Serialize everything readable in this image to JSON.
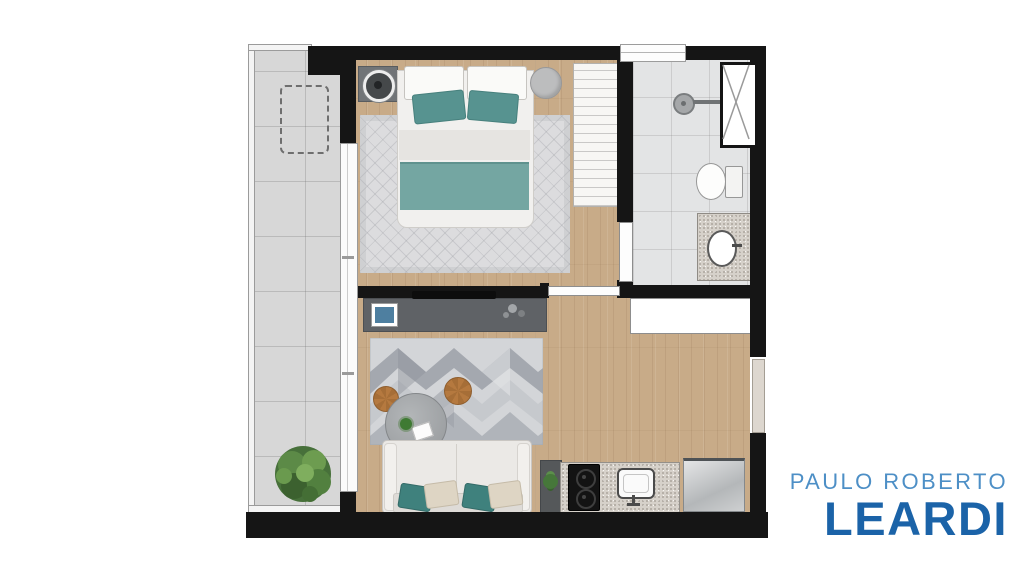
{
  "logo": {
    "line1": "PAULO ROBERTO",
    "line2": "LEARDI",
    "line1_color": "#4d8fc6",
    "line2_color": "#1b63a8"
  },
  "palette": {
    "wall": "#151515",
    "wood_floor": "#c8ab88",
    "balcony_tile": "#d7d7d7",
    "bathroom_tile": "#e3e4e5",
    "teal_accent": "#579390",
    "teal_blanket": "#74a6a2",
    "rug_gray": "#dcdcde",
    "chevron_rug_grays": [
      "#d3d5d8",
      "#a4a8af",
      "#c6c9cd",
      "#b0b4ba"
    ],
    "console_gray": "#5f6266",
    "granite": "#d6d1ca",
    "pouf_brown": "#b5793f",
    "plant_green": "#4e7d3c"
  },
  "floorplan": {
    "kind": "studio-apartment-floor-plan-top-view",
    "rooms": [
      {
        "name": "balcony",
        "features": [
          "glass-railing",
          "tile-floor",
          "dashed-utility-area",
          "potted-plant",
          "sliding-glass-door"
        ]
      },
      {
        "name": "bedroom",
        "features": [
          "double-bed",
          "white-pillows",
          "teal-pillows",
          "teal-blanket",
          "diamond-rug",
          "nightstand",
          "lamp",
          "round-side-table",
          "wardrobe"
        ]
      },
      {
        "name": "bathroom",
        "features": [
          "shower-head",
          "ventilation-window",
          "toilet",
          "granite-sink-counter",
          "door"
        ]
      },
      {
        "name": "living-room",
        "features": [
          "tv-panel",
          "wall-tv",
          "picture-frame",
          "chevron-rug",
          "round-coffee-table",
          "wooden-poufs",
          "sofa",
          "sofa-pillows"
        ]
      },
      {
        "name": "kitchen",
        "features": [
          "granite-countertop",
          "cooktop",
          "sink",
          "refrigerator",
          "small-plant"
        ]
      },
      {
        "name": "hall",
        "features": [
          "entrance-door",
          "white-cabinet",
          "bedroom-door"
        ]
      }
    ]
  }
}
